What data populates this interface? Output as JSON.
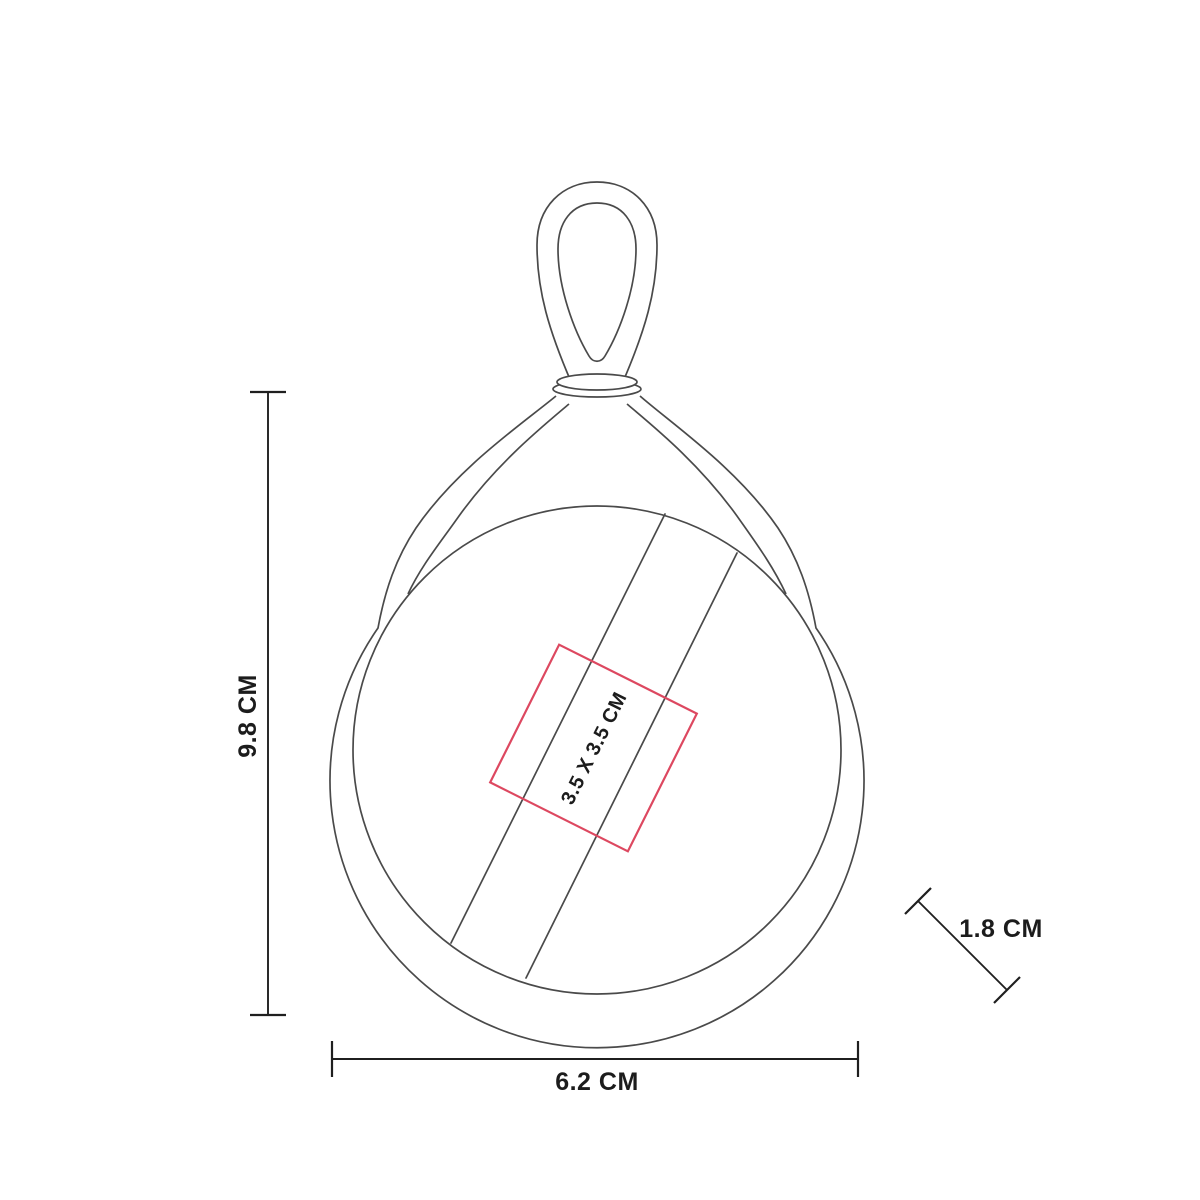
{
  "diagram": {
    "type": "product-dimension-diagram",
    "product_parts": [
      "hanging-loop",
      "swivel-collar",
      "teardrop-body",
      "circular-face",
      "hand-strap",
      "imprint-area"
    ],
    "labels": {
      "height": "9.8 CM",
      "width": "6.2 CM",
      "strap": "1.8 CM",
      "imprint": "3.5 X 3.5 CM"
    },
    "colors": {
      "outline": "#4a4a4a",
      "dimension_line": "#1f1f1f",
      "imprint_area": "#dd4860",
      "text": "#1c1c1c",
      "background": "#ffffff"
    }
  }
}
